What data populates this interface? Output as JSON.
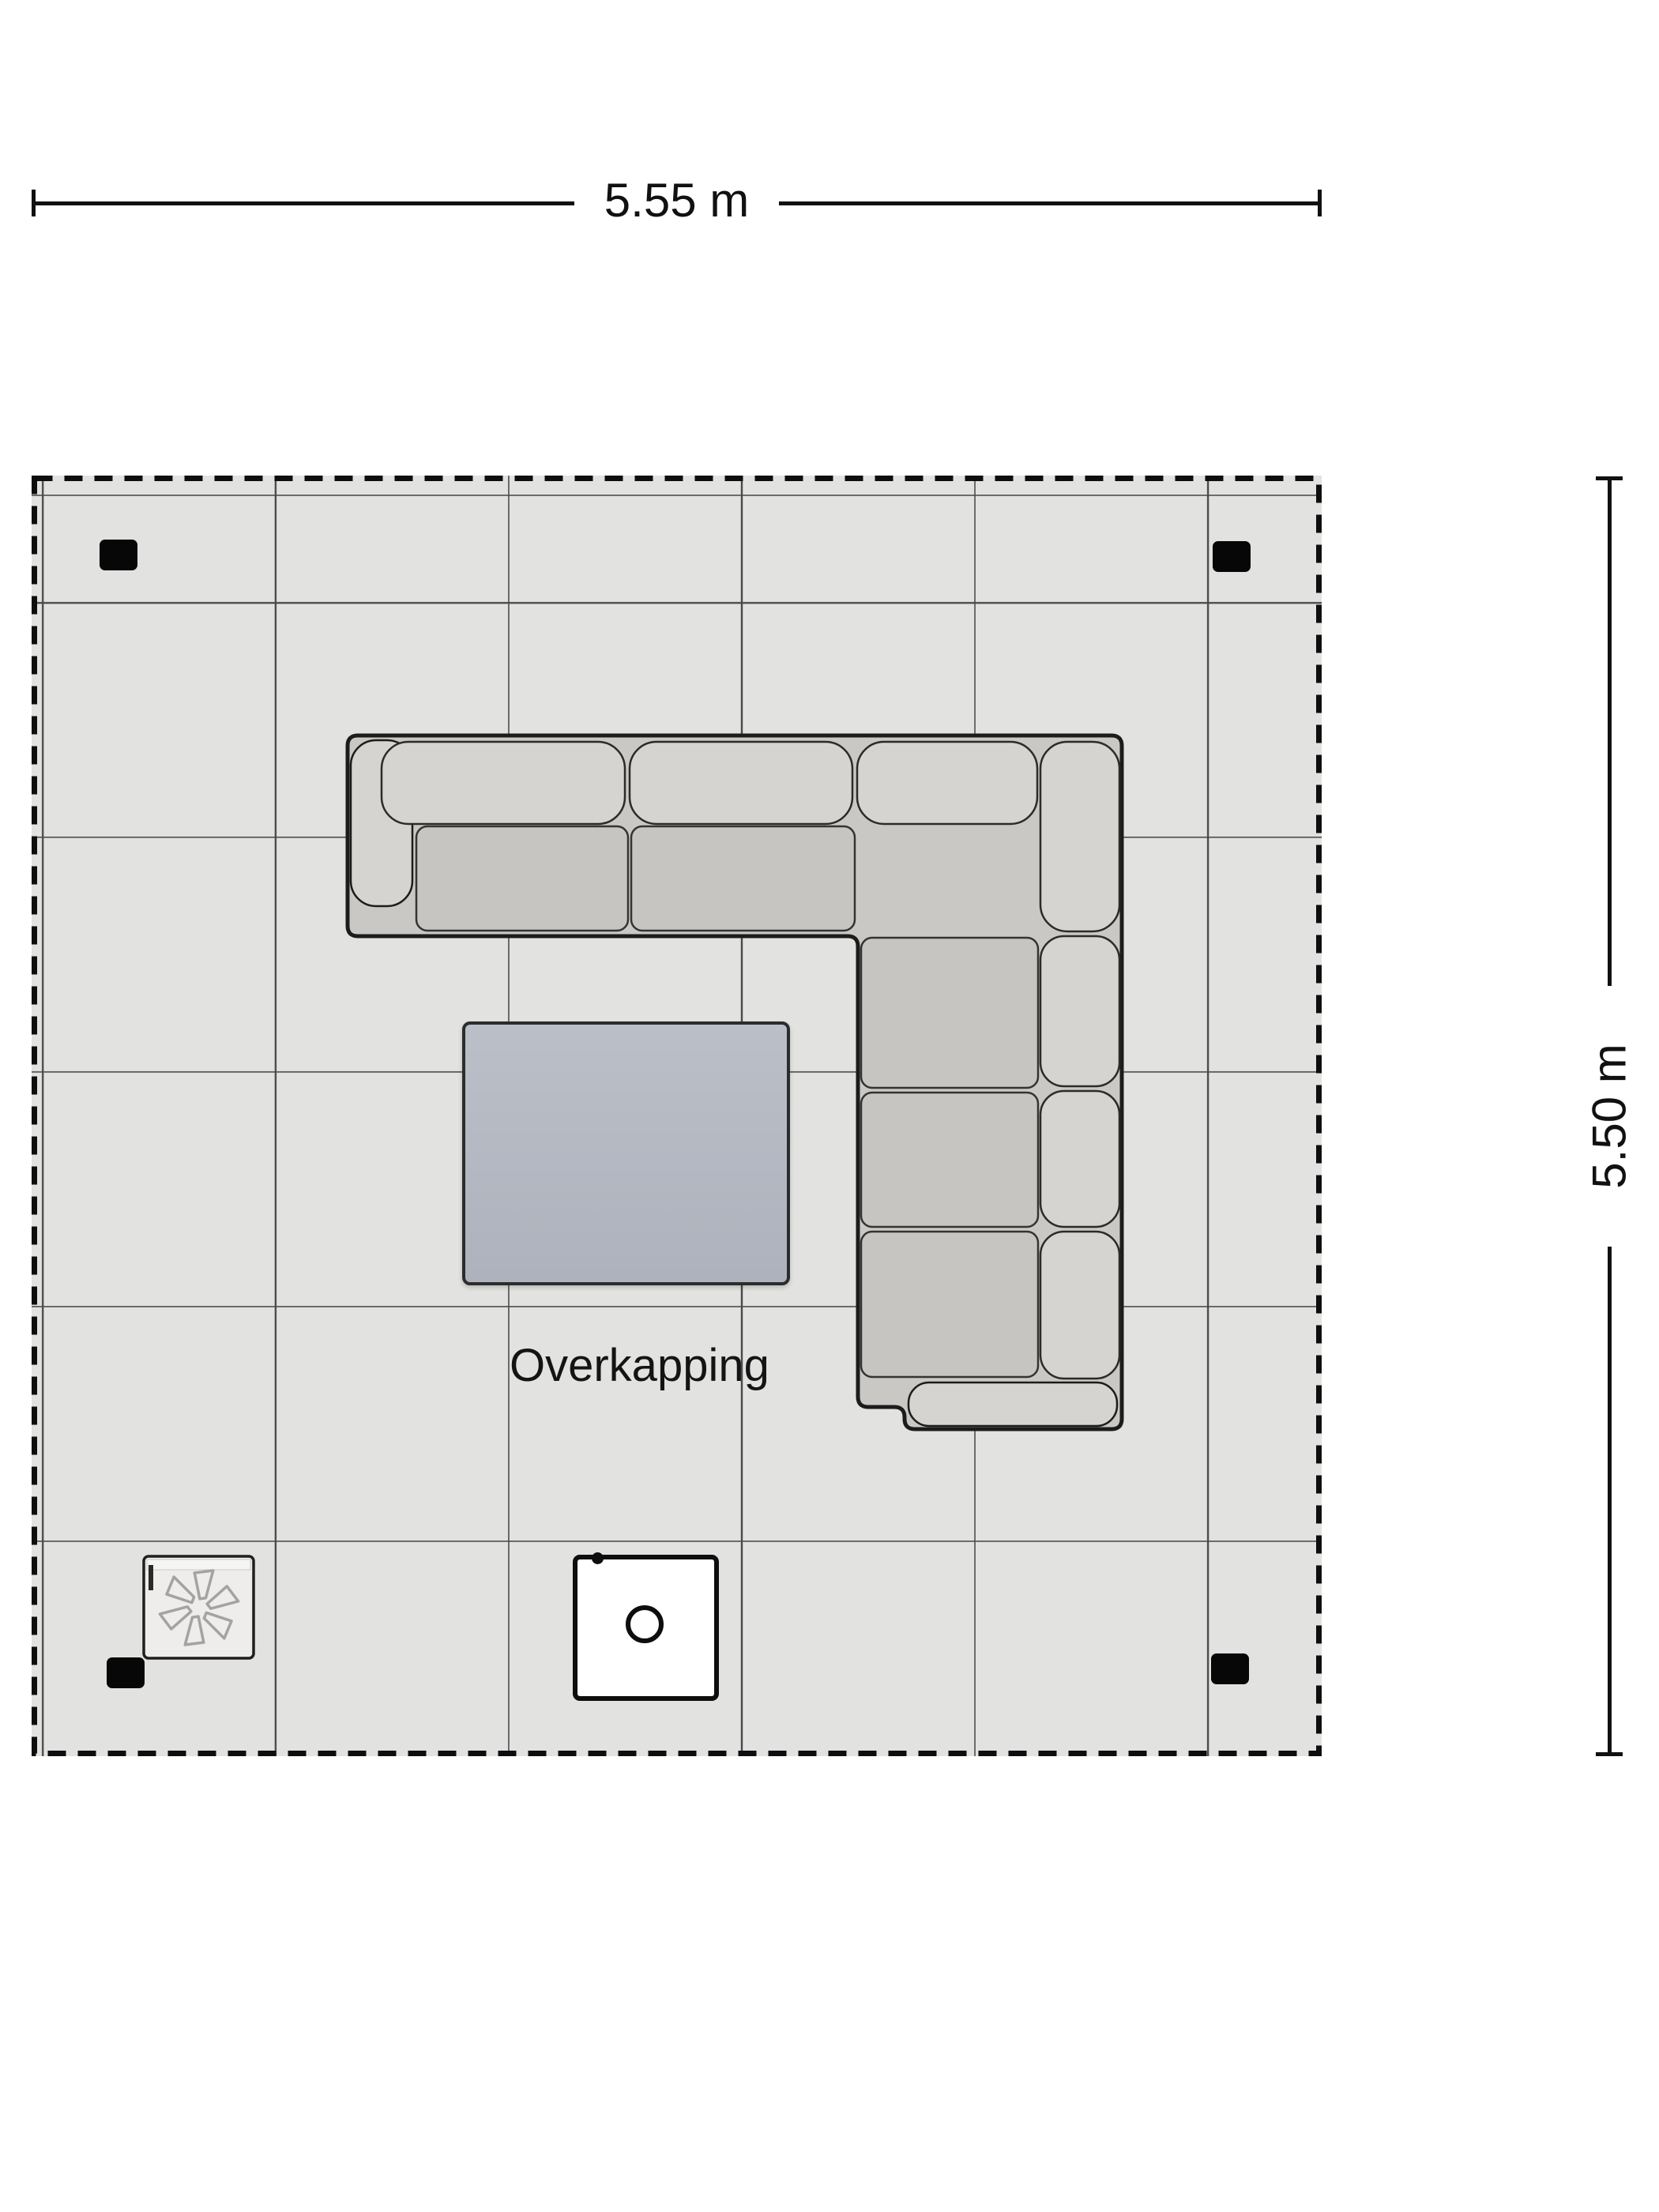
{
  "labels": {
    "area": "Overkapping",
    "dim_width": "5.55 m",
    "dim_height": "5.50 m"
  },
  "colors": {
    "page-bg": "#ffffff",
    "terrace-fill": "#e2e2e1",
    "grid-line": "#4a4a4a",
    "border-dash": "#0e0e0e",
    "dim-line": "#111111",
    "text": "#141414",
    "sofa-shell": "#c9c8c5",
    "sofa-cushion": "#d5d4d1",
    "sofa-seat": "#c6c5c2",
    "sofa-outline": "#1c1c1c",
    "table-fill-top": "#babfc8",
    "table-fill-bottom": "#adb2bc",
    "table-border": "#2c2c2c",
    "post-fill": "#070707",
    "appliance-fill": "#eeedec",
    "appliance-border": "#1f1f1f",
    "fan-stroke": "#a3a3a3",
    "firetable-fill": "#ffffff",
    "firetable-border": "#0e0e0e"
  }
}
